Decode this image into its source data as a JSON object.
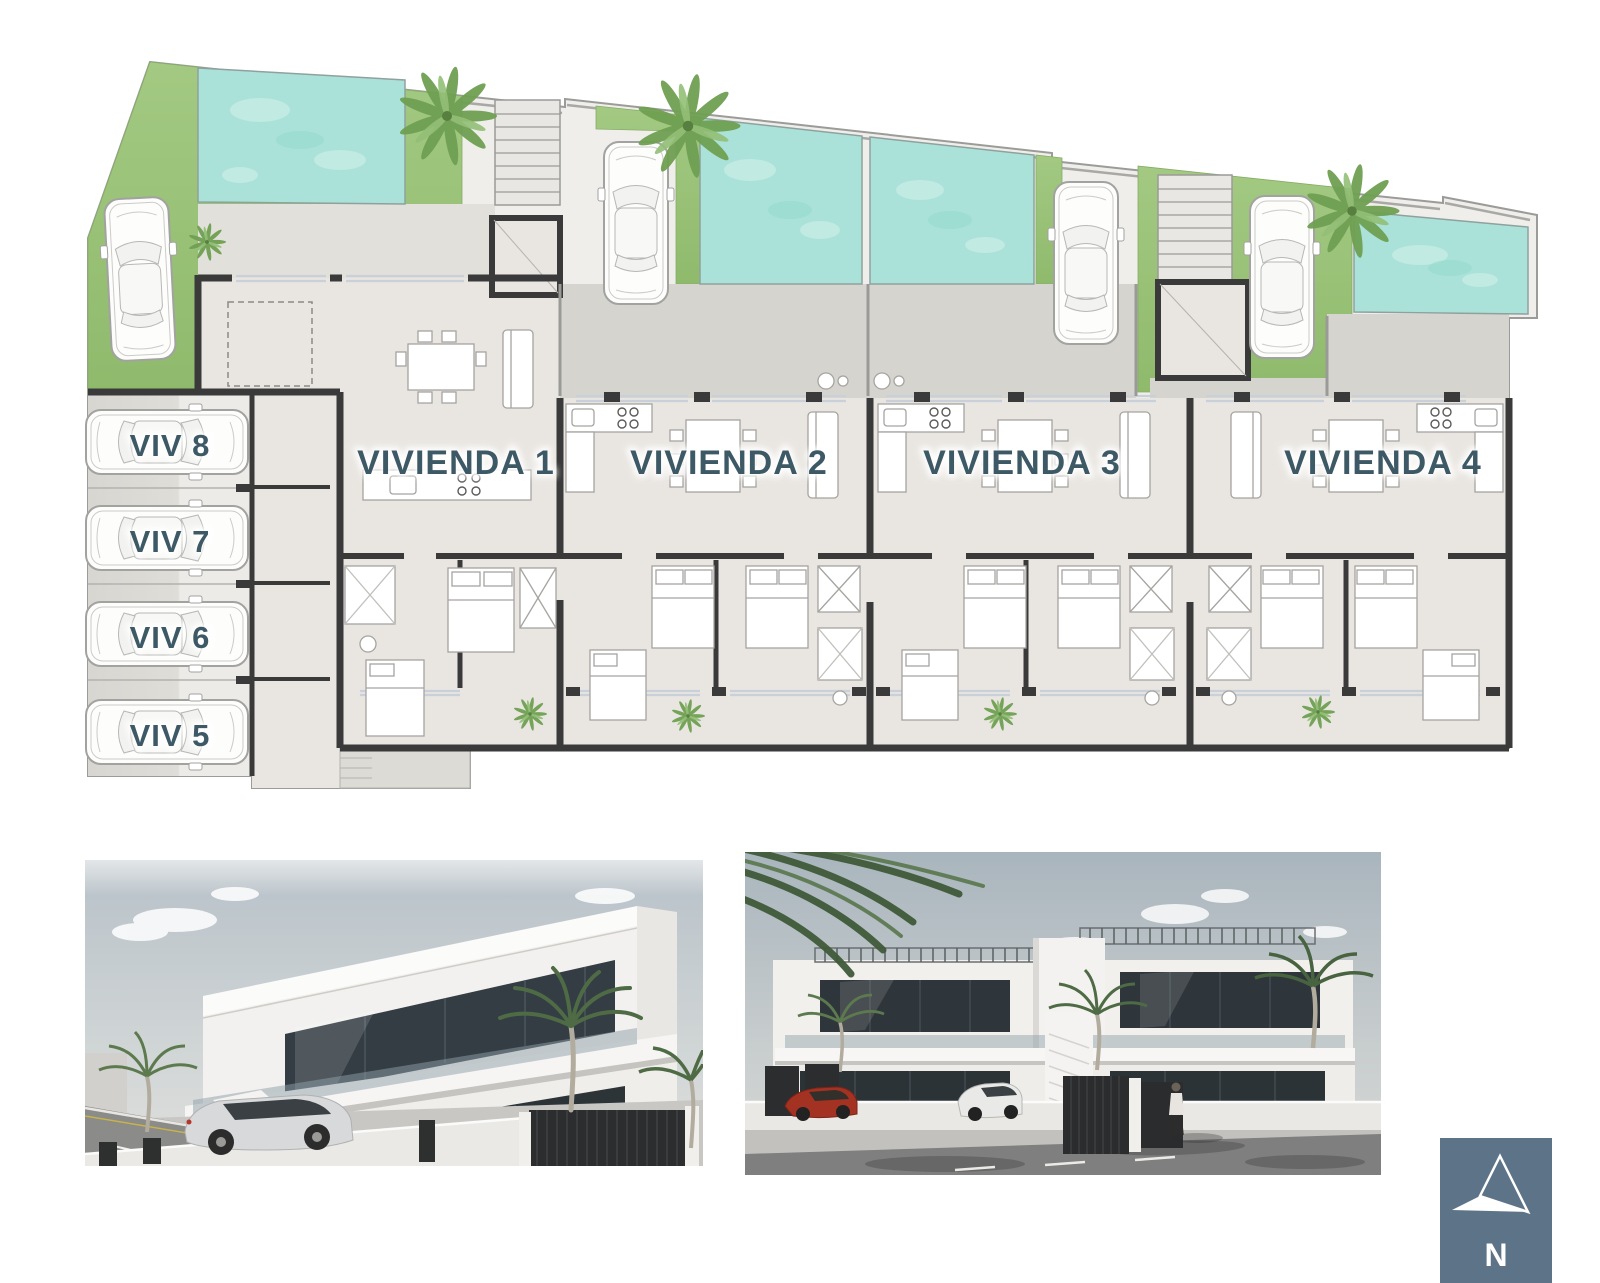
{
  "floor_plan": {
    "units": [
      {
        "id": "vivienda-1",
        "label": "VIVIENDA 1"
      },
      {
        "id": "vivienda-2",
        "label": "VIVIENDA 2"
      },
      {
        "id": "vivienda-3",
        "label": "VIVIENDA 3"
      },
      {
        "id": "vivienda-4",
        "label": "VIVIENDA 4"
      }
    ],
    "parking_spots": [
      {
        "id": "viv-8",
        "label": "VIV 8"
      },
      {
        "id": "viv-7",
        "label": "VIV 7"
      },
      {
        "id": "viv-6",
        "label": "VIV 6"
      },
      {
        "id": "viv-5",
        "label": "VIV 5"
      }
    ],
    "label_color": "#3d5966",
    "colors": {
      "grass": "#9cc47c",
      "pool_water": "#aae2d9",
      "terrace": "#d6d4cf",
      "walkway": "#e2e0db",
      "interior_floor": "#e9e6e1",
      "walls": "#3a3a3a"
    }
  },
  "compass": {
    "label": "N",
    "background": "#5d7488",
    "needle_color": "#ffffff"
  }
}
